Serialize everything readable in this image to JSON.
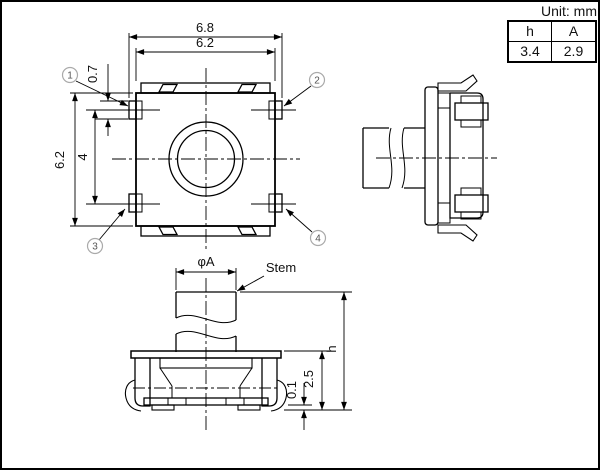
{
  "unit_label": "Unit: mm",
  "spec_table": {
    "headers": [
      "h",
      "A"
    ],
    "rows": [
      [
        "3.4",
        "2.9"
      ]
    ]
  },
  "top_view": {
    "dims": {
      "outer_width": "6.8",
      "body_width": "6.2",
      "body_height": "6.2",
      "terminal_pitch": "4",
      "terminal_height": "0.7"
    },
    "callouts": [
      {
        "label": "1"
      },
      {
        "label": "2"
      },
      {
        "label": "3"
      },
      {
        "label": "4"
      }
    ]
  },
  "front_view": {
    "stem_label": "Stem",
    "dims": {
      "stem_diameter": "φA",
      "total_height": "h",
      "body_height": "2.5",
      "standoff": "0.1"
    }
  },
  "colors": {
    "line": "#000000",
    "callout_ring": "#aaaaaa",
    "frame": "#000000"
  }
}
